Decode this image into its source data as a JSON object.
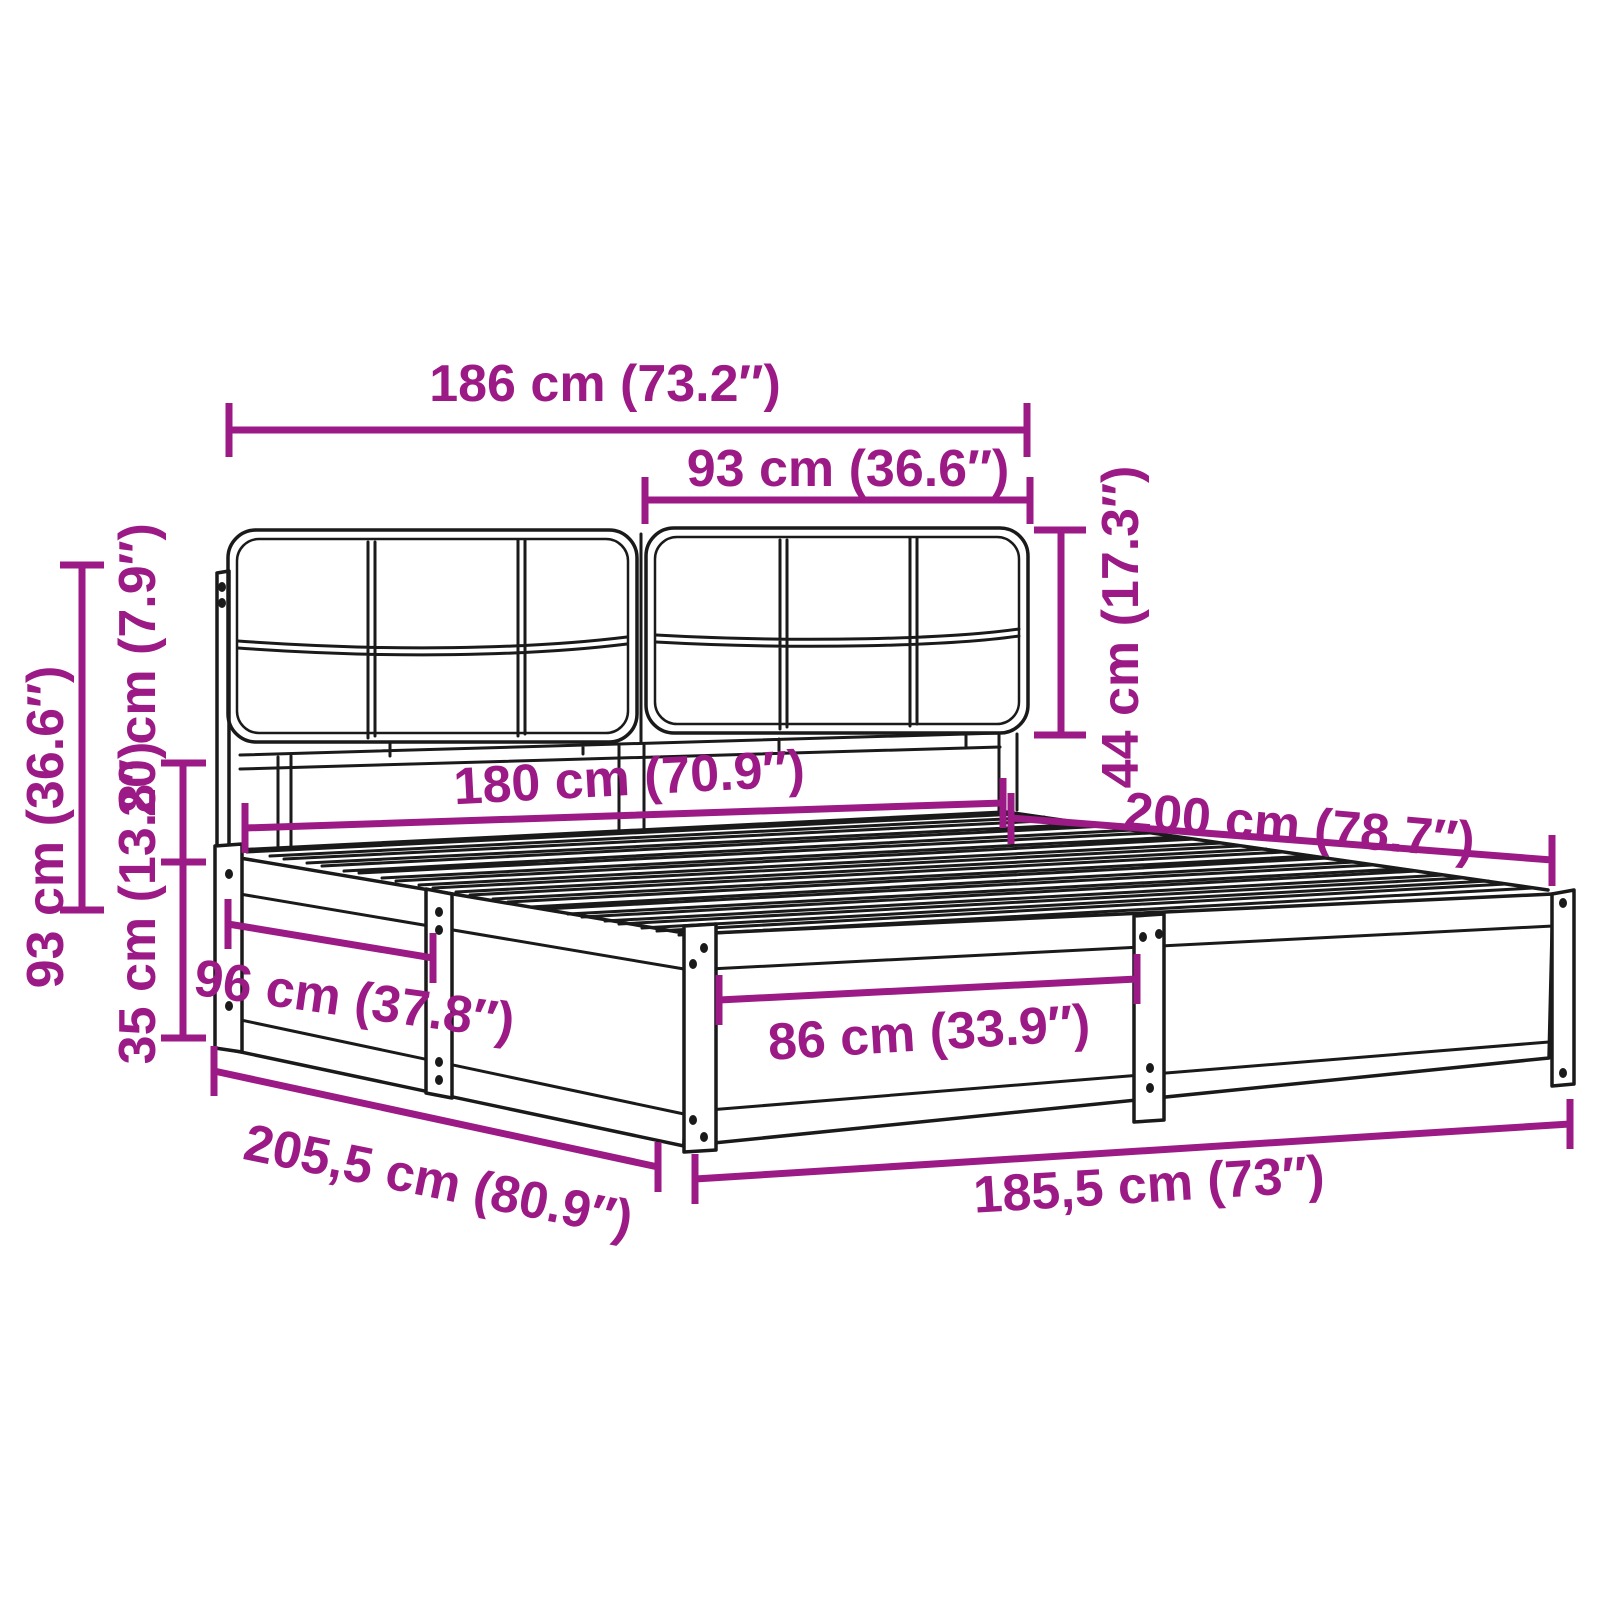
{
  "diagram": {
    "alt": "Line drawing of a bed frame with a two-piece upholstered headboard, slatted base and annotated measurements",
    "colors": {
      "accent": "#9B1A85",
      "outline": "#1A1A1A",
      "background": "#FFFFFF"
    },
    "dimensions": {
      "headboard_total_width": {
        "label": "186 cm (73.2″)",
        "cm": 186,
        "inches": 73.2
      },
      "headboard_section_width": {
        "label": "93 cm (36.6″)",
        "cm": 93,
        "inches": 36.6
      },
      "headboard_cushion_height": {
        "label": "44 cm (17.3″)",
        "cm": 44,
        "inches": 17.3
      },
      "headboard_height": {
        "label": "93 cm (36.6″)",
        "cm": 93,
        "inches": 36.6
      },
      "headboard_to_slats_gap": {
        "label": "20 cm (7.9″)",
        "cm": 20,
        "inches": 7.9
      },
      "frame_side_height": {
        "label": "35 cm (13.8″)",
        "cm": 35,
        "inches": 13.8
      },
      "mattress_width": {
        "label": "180 cm (70.9″)",
        "cm": 180,
        "inches": 70.9
      },
      "mattress_length": {
        "label": "200 cm (78.7″)",
        "cm": 200,
        "inches": 78.7
      },
      "side_panel_section": {
        "label": "96 cm (37.8″)",
        "cm": 96,
        "inches": 37.8
      },
      "front_panel_section": {
        "label": "86 cm (33.9″)",
        "cm": 86,
        "inches": 33.9
      },
      "total_length": {
        "label": "205,5 cm (80.9″)",
        "cm": 205.5,
        "inches": 80.9
      },
      "total_width": {
        "label": "185,5 cm (73″)",
        "cm": 185.5,
        "inches": 73
      }
    }
  }
}
